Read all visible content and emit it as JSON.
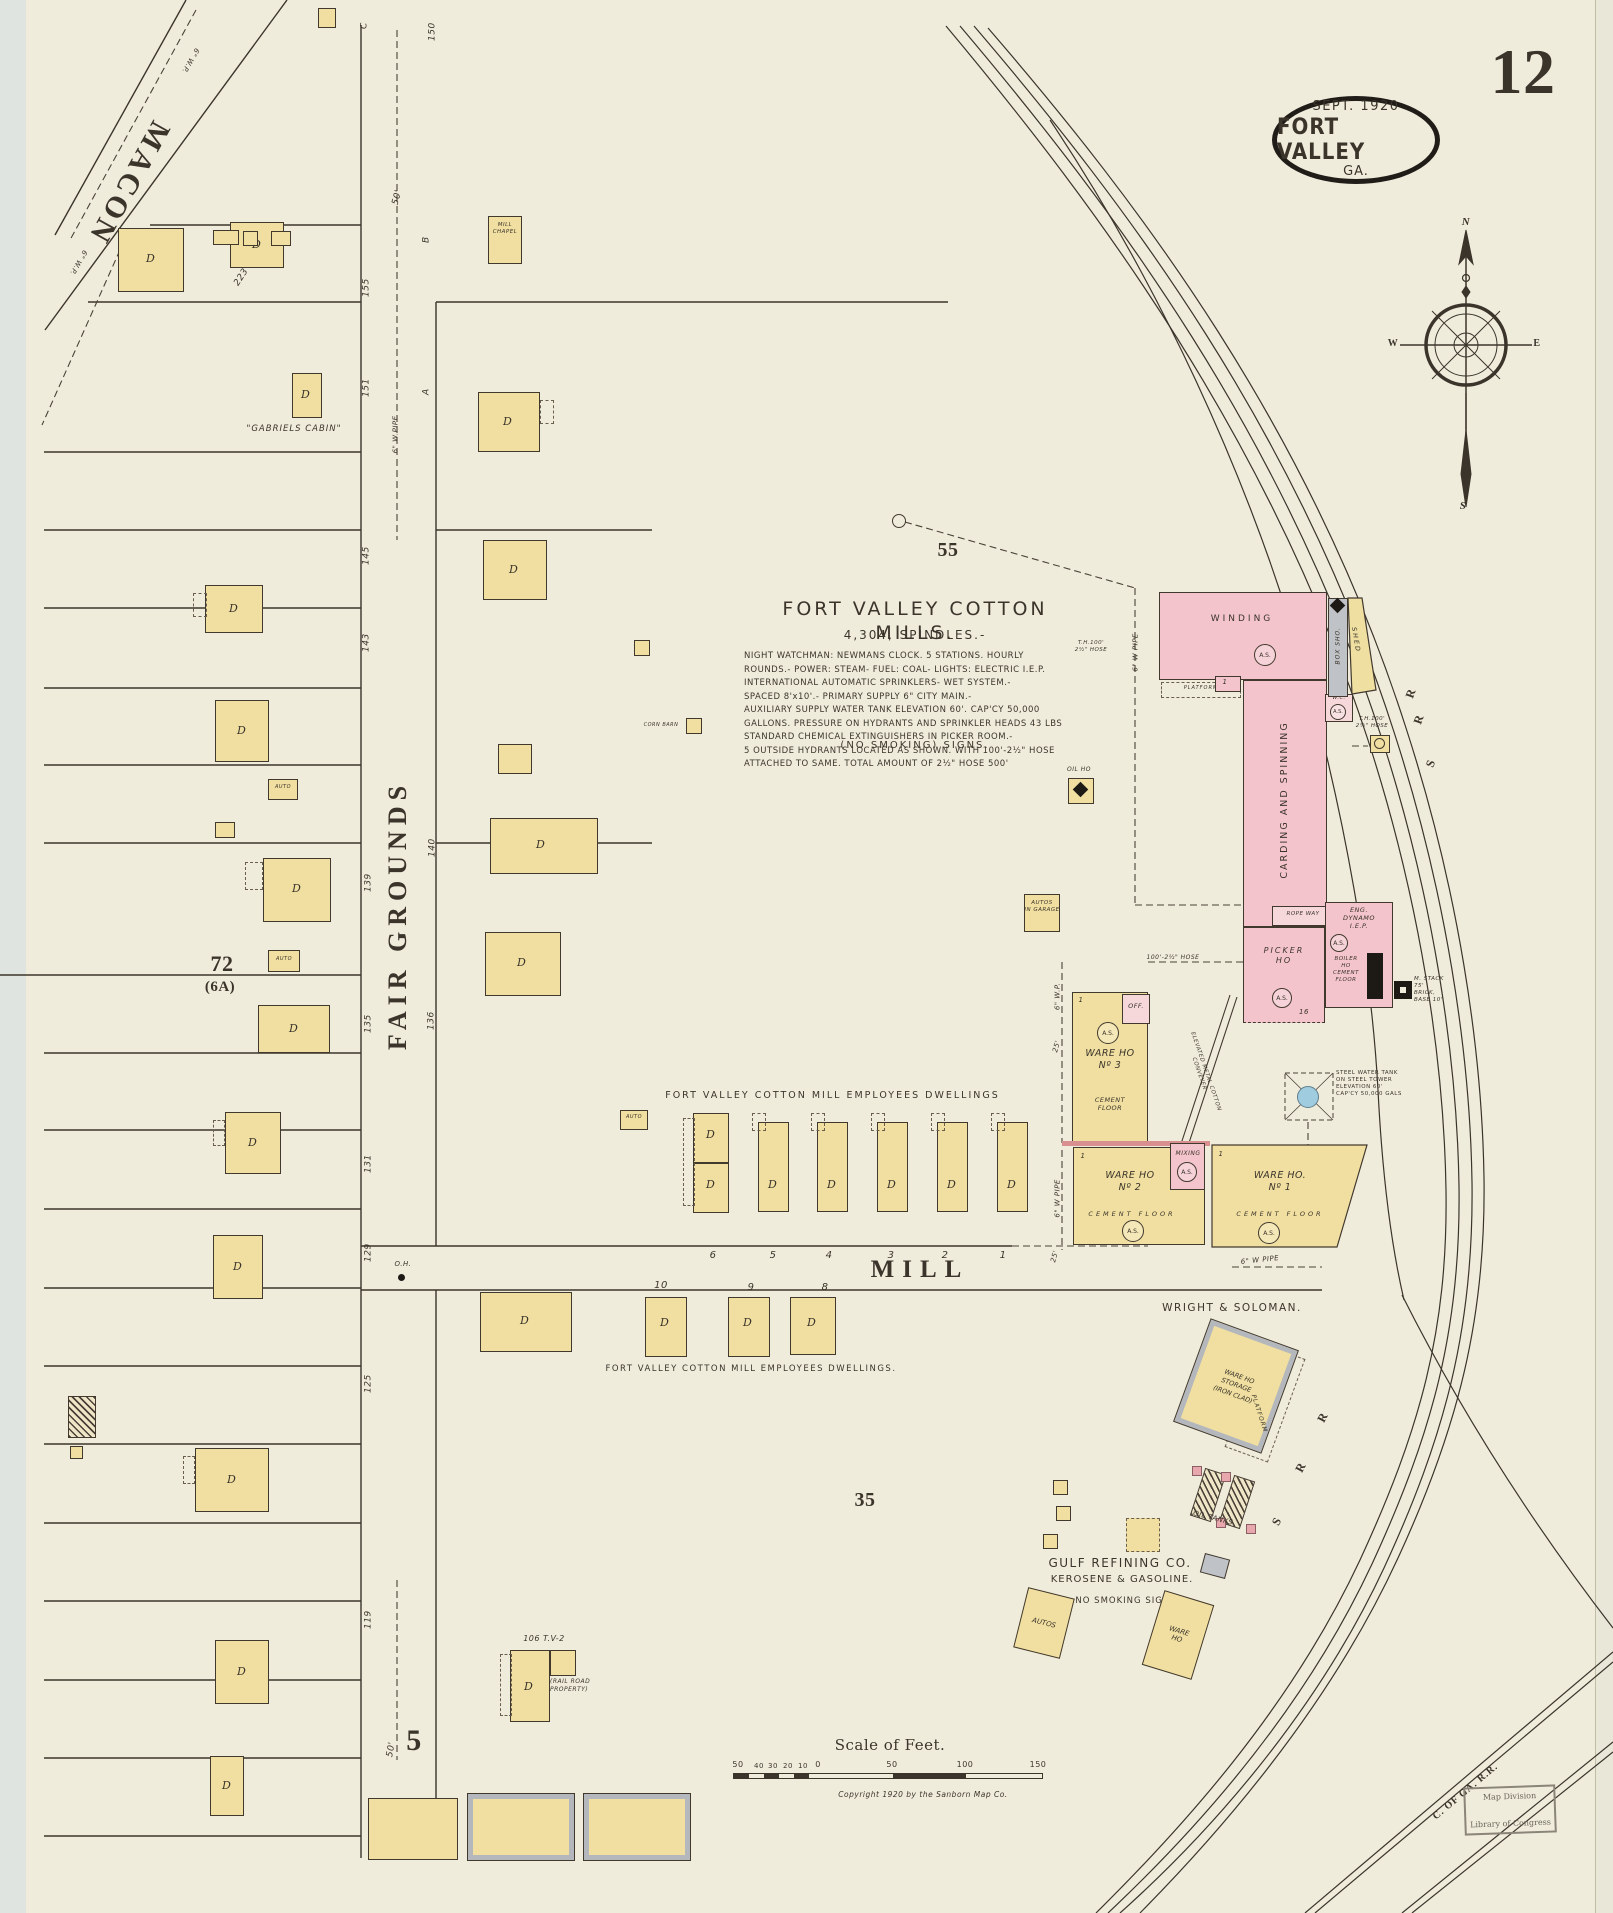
{
  "page": {
    "sheet_number": "12",
    "publisher_stamp": {
      "date": "SEPT. 1920",
      "city": "FORT VALLEY",
      "state": "GA."
    },
    "library_stamp": {
      "line1": "Map Division",
      "line2": "Library of Congress"
    }
  },
  "compass": {
    "north": "N",
    "west": "W",
    "east": "E",
    "south": "S"
  },
  "streets": {
    "macon": "MACON",
    "fair_grounds": "FAIR GROUNDS",
    "mill": "MILL"
  },
  "railroads": {
    "srr_letters": [
      "S",
      "R",
      "R"
    ],
    "central_ga": "C. OF GA. R.R."
  },
  "blocks": {
    "b55": "55",
    "b35": "35",
    "b72": "72",
    "b6a": "(6A)",
    "b5": "5"
  },
  "mill_note": {
    "title": "FORT VALLEY COTTON MILLS.",
    "spindles": "4,304, SPINDLES.-",
    "body": "NIGHT WATCHMAN: NEWMANS CLOCK. 5 STATIONS. HOURLY\nROUNDS.- POWER: STEAM- FUEL: COAL- LIGHTS: ELECTRIC I.E.P.\nINTERNATIONAL AUTOMATIC SPRINKLERS- WET SYSTEM.-\nSPACED 8'x10'.- PRIMARY SUPPLY 6\" CITY MAIN.-\nAUXILIARY SUPPLY WATER TANK ELEVATION 60'. CAP'CY 50,000\nGALLONS. PRESSURE ON HYDRANTS AND SPRINKLER HEADS 43 LBS\nSTANDARD CHEMICAL EXTINGUISHERS IN PICKER ROOM.-\n5 OUTSIDE HYDRANTS LOCATED AS SHOWN. WITH 100'-2½\" HOSE\nATTACHED TO SAME. TOTAL AMOUNT OF 2½\" HOSE 500'",
    "no_smoking": "(NO SMOKING) SIGNS."
  },
  "mill": {
    "winding": "WINDING",
    "carding": "CARDING AND SPINNING",
    "picker": "PICKER\nHO",
    "rope_way": "ROPE WAY",
    "eng": "ENG.\nDYNAMO\nI.E.P.",
    "boiler": "BOILER\nHO\nCEMENT\nFLOOR",
    "stack": "M. STACK\n75'\nBRICK,\nBASE 10'",
    "box_shop": "BOX SHO.",
    "shed": "SHED",
    "wc": "W.C.",
    "platform": "PLATFORM",
    "water_tank": "STEEL WATER TANK\nON STEEL TOWER\nELEVATION 60'\nCAP'CY 50,000 GALS",
    "conveyor": "ELEVATED METAL COTTON CONVEYER",
    "mixing": "MIXING",
    "off": "OFF.",
    "ware1": "WARE HO.\nNº 1",
    "ware2": "WARE HO\nNº 2",
    "ware3": "WARE HO\nNº 3",
    "cement": "CEMENT\nFLOOR",
    "cement_line": "CEMENT FLOOR",
    "st16": "16"
  },
  "annotations": {
    "macon_pipe": "6\" W.P.",
    "fg_pipe": "6\" W.PIPE",
    "pipe6": "6\" W PIPE",
    "pipe6wp": "6\" W.P.",
    "p25": "25'",
    "oh": "O.H.",
    "th_hose": "T.H.100'\n2½\" HOSE",
    "hose100": "100'-2½\" HOSE",
    "employees1": "FORT VALLEY COTTON MILL EMPLOYEES DWELLINGS",
    "employees2": "FORT VALLEY COTTON MILL EMPLOYEES DWELLINGS.",
    "wright": "WRIGHT & SOLOMAN.",
    "ware_storage": "WARE HO\nSTORAGE\n(IRON CLAD)",
    "platform": "PLATFORM",
    "oil_tanks": "OIL TANKS",
    "gulf1": "GULF REFINING CO.",
    "gulf2": "KEROSENE & GASOLINE.",
    "no_smoking": "NO SMOKING SIGNS",
    "autos": "AUTOS",
    "autos_garage": "AUTOS\nIN GARAGE",
    "ware_ho": "WARE\nHO",
    "rr_property": "(RAIL ROAD\nPROPERTY)",
    "tv106": "106 T.V-2",
    "gabriels": "\"GABRIELS CABIN\"",
    "mill_chapel": "MILL\nCHAPEL",
    "corn_barn": "CORN BARN",
    "oil_ho": "OIL HO"
  },
  "lot_numbers": {
    "n223": "223",
    "n155": "155",
    "n151": "151",
    "n145": "145",
    "n143": "143",
    "n139": "139",
    "n135": "135",
    "n131": "131",
    "n129": "129",
    "n125": "125",
    "n119": "119",
    "n150": "150",
    "n140": "140",
    "n136": "136",
    "nA": "A",
    "nB": "B",
    "nC": "C",
    "n50a": "50'",
    "n50b": "50'"
  },
  "house_numbers": {
    "north": [
      "6",
      "5",
      "4",
      "3",
      "2",
      "1"
    ],
    "south": [
      "10",
      "9",
      "8"
    ]
  },
  "labels": {
    "d": "D",
    "auto": "AUTO",
    "as": "A.S.",
    "one": "1"
  },
  "scale_bar": {
    "title": "Scale of Feet.",
    "left_ticks": [
      "50",
      "40",
      "30",
      "20",
      "10"
    ],
    "zero": "0",
    "right_ticks": [
      "50",
      "100",
      "150"
    ],
    "copyright": "Copyright 1920 by the Sanborn Map Co."
  },
  "colors": {
    "paper": "#f0ecdc",
    "ink": "#3b342b",
    "frame_yellow": "#f0dfa0",
    "brick_pink": "#f3c4cb",
    "iron_gray": "#b4b8bc",
    "water_blue": "#9fccdf"
  }
}
